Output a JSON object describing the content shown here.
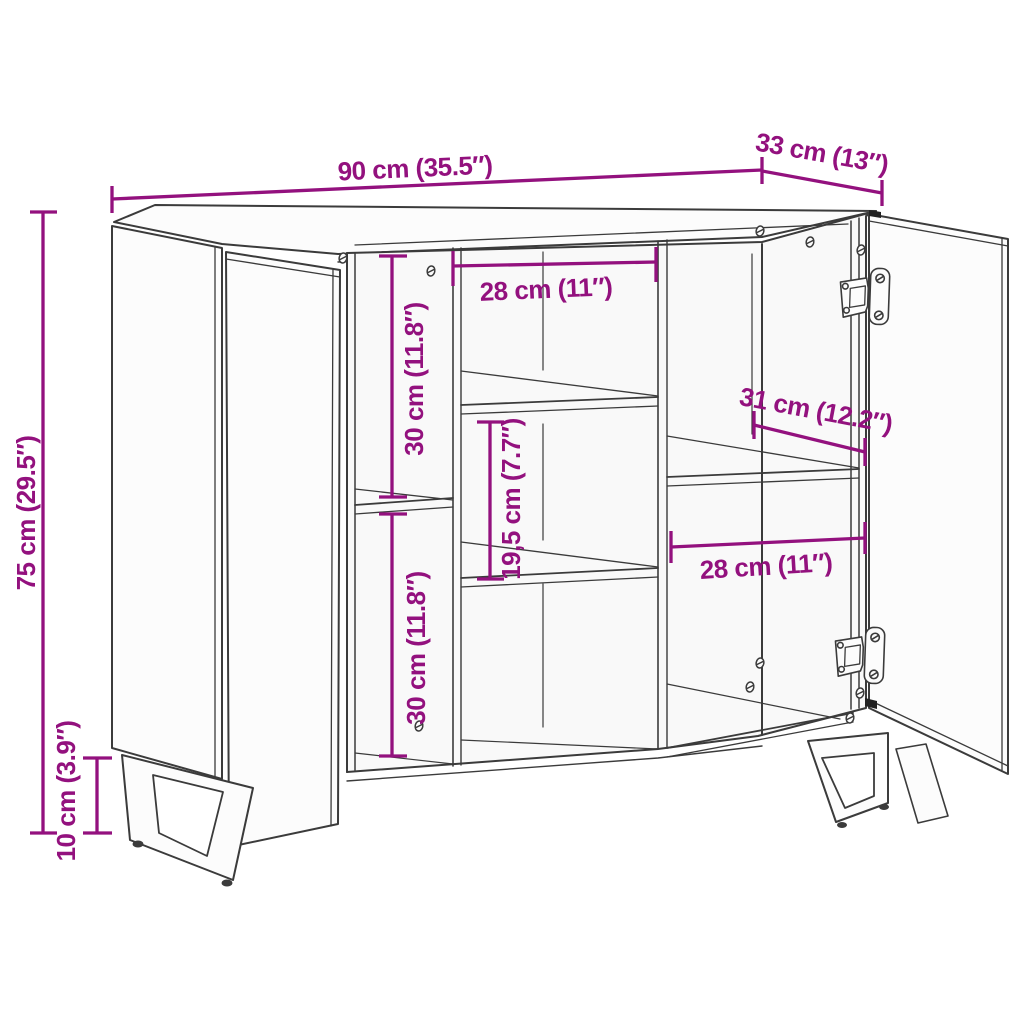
{
  "diagram": {
    "type": "furniture-dimension-diagram",
    "product": "sideboard with two open doors, interior shelves and U-shaped metal legs",
    "colors": {
      "dimension": "#93117E",
      "outline": "#3b3b3b",
      "panel": "#fcfcfc",
      "background": "#ffffff"
    },
    "dims": {
      "width": {
        "label": "90 cm (35.5″)"
      },
      "depth": {
        "label": "33 cm (13″)"
      },
      "height": {
        "label": "75 cm (29.5″)"
      },
      "leg_height": {
        "label": "10 cm (3.9″)"
      },
      "inner_width_middle": {
        "label": "28 cm (11″)"
      },
      "inner_height_upper": {
        "label": "30 cm (11.8″)"
      },
      "inner_height_middle": {
        "label": "19,5 cm (7.7″)"
      },
      "inner_height_lower": {
        "label": "30 cm (11.8″)"
      },
      "inner_depth_right": {
        "label": "31 cm (12.2″)"
      },
      "inner_width_right": {
        "label": "28 cm (11″)"
      }
    }
  }
}
